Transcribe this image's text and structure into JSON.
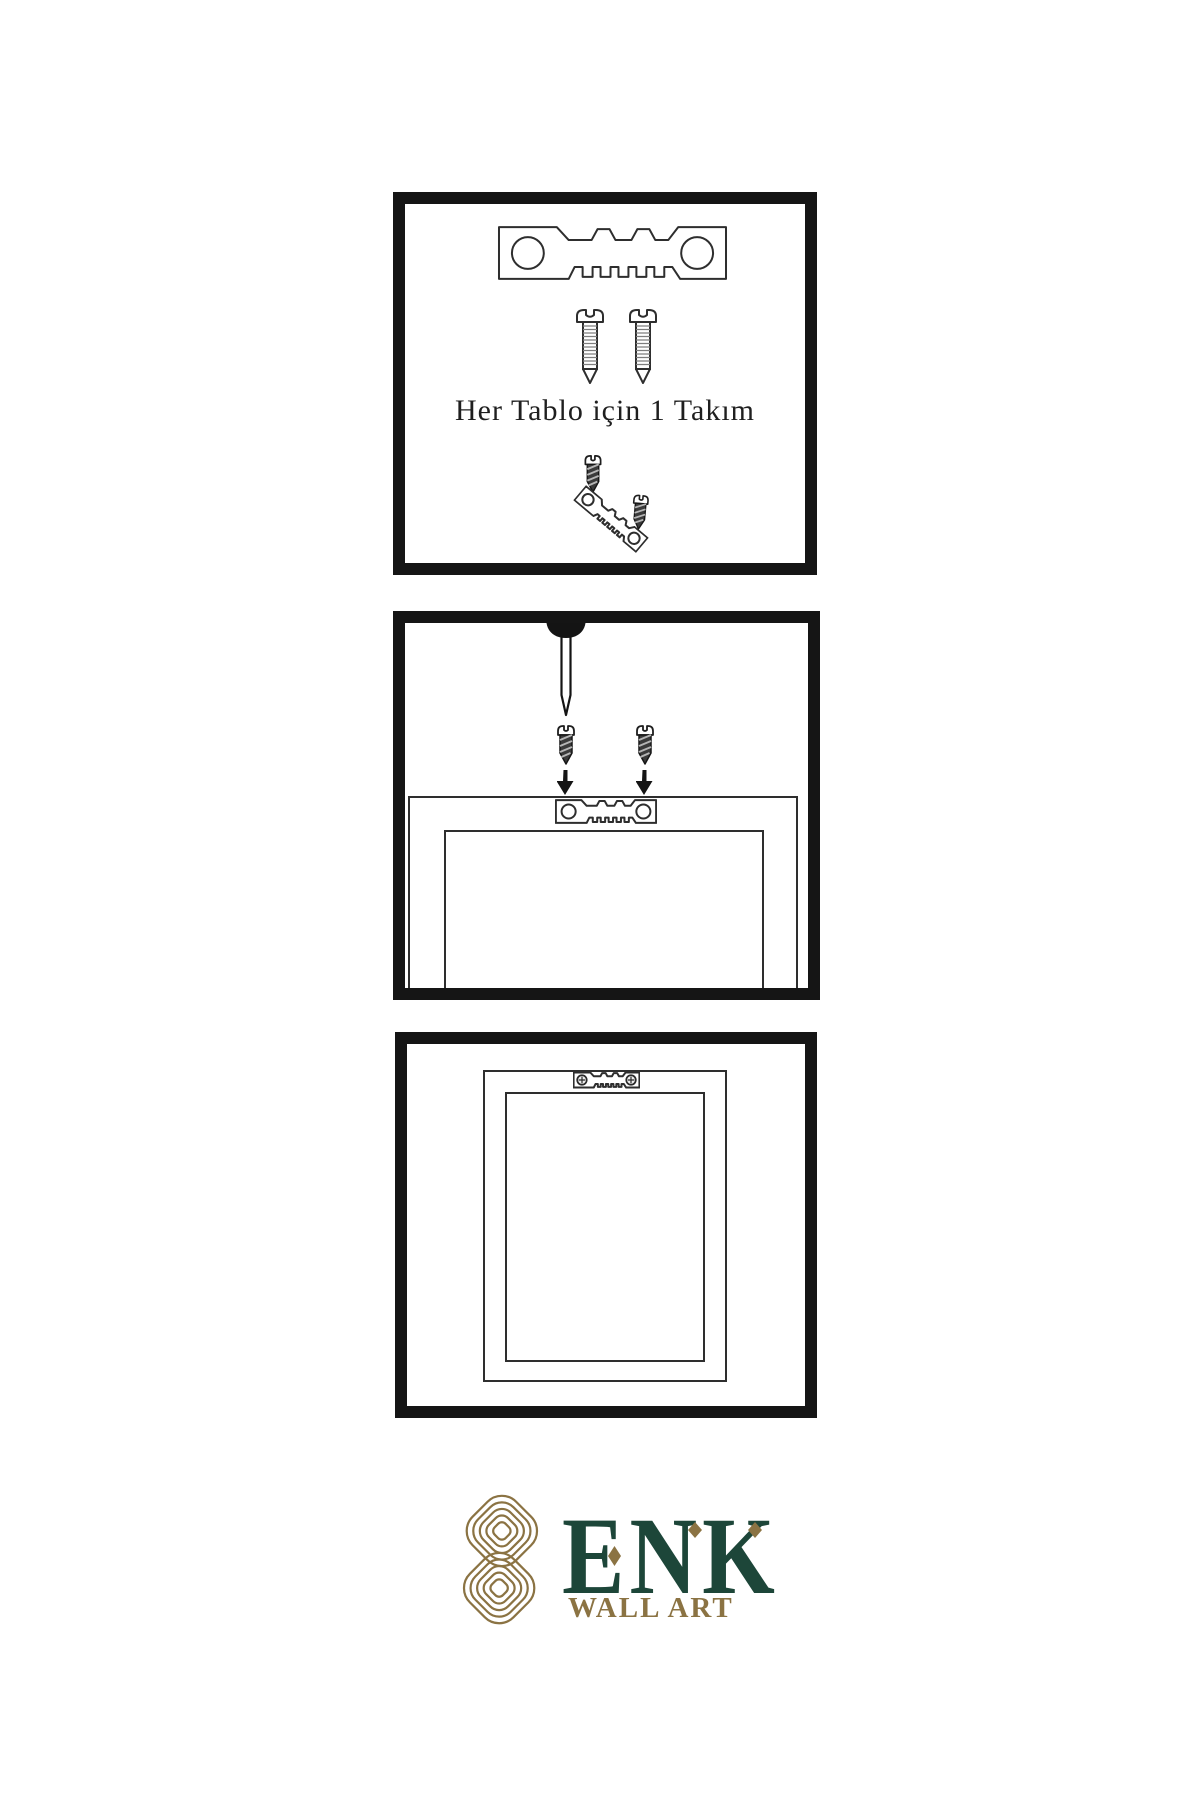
{
  "canvas": {
    "background": "#ffffff"
  },
  "colors": {
    "ink": "#1b1b1b",
    "line": "#2e2e2e",
    "screw-dark": "#3a3a3a",
    "gold": "#8b7343",
    "green": "#1d4639"
  },
  "step_kit": {
    "caption": "Her Tablo için 1 Takım"
  },
  "brand": {
    "name": "ENK",
    "tagline": "WALL ART"
  }
}
